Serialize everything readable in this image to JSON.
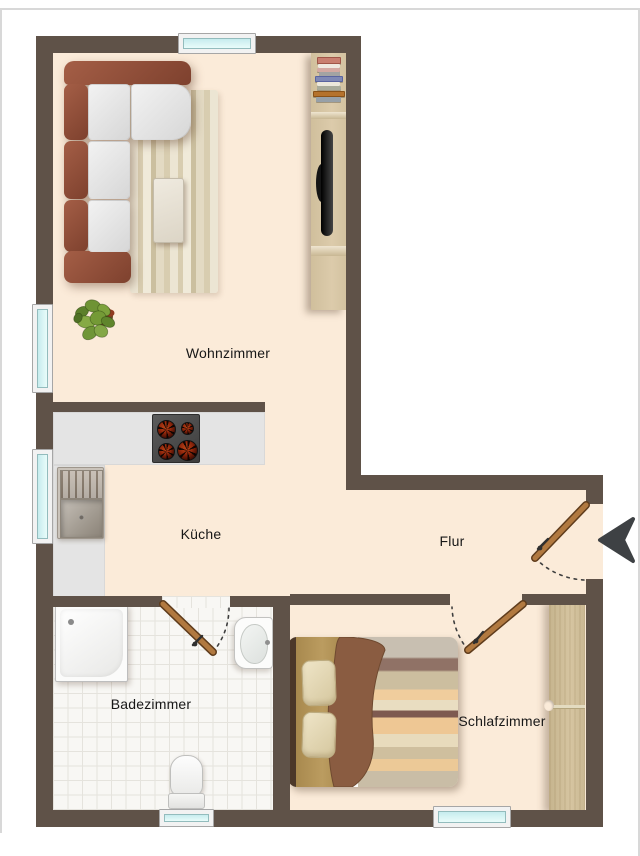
{
  "rooms": [
    {
      "id": "wohnzimmer",
      "label": "Wohnzimmer"
    },
    {
      "id": "kueche",
      "label": "Küche"
    },
    {
      "id": "flur",
      "label": "Flur"
    },
    {
      "id": "badezimmer",
      "label": "Badezimmer"
    },
    {
      "id": "schlafzimmer",
      "label": "Schlafzimmer"
    }
  ],
  "palette": {
    "wall": "#5f5248",
    "floor": "#fbebd9",
    "counter": "#e4e4e4",
    "tile": "#f8f7f4",
    "wood": "#cfbd99",
    "door": "#ad743c",
    "arrow": "#3e4144",
    "label": "#171717",
    "edge": "#d8d8d8",
    "glass-a": "#c6ecee",
    "glass-b": "#e9fcfa"
  },
  "icons": {
    "plant": "plant-icon",
    "entry_arrow": "entry-arrow-icon"
  }
}
